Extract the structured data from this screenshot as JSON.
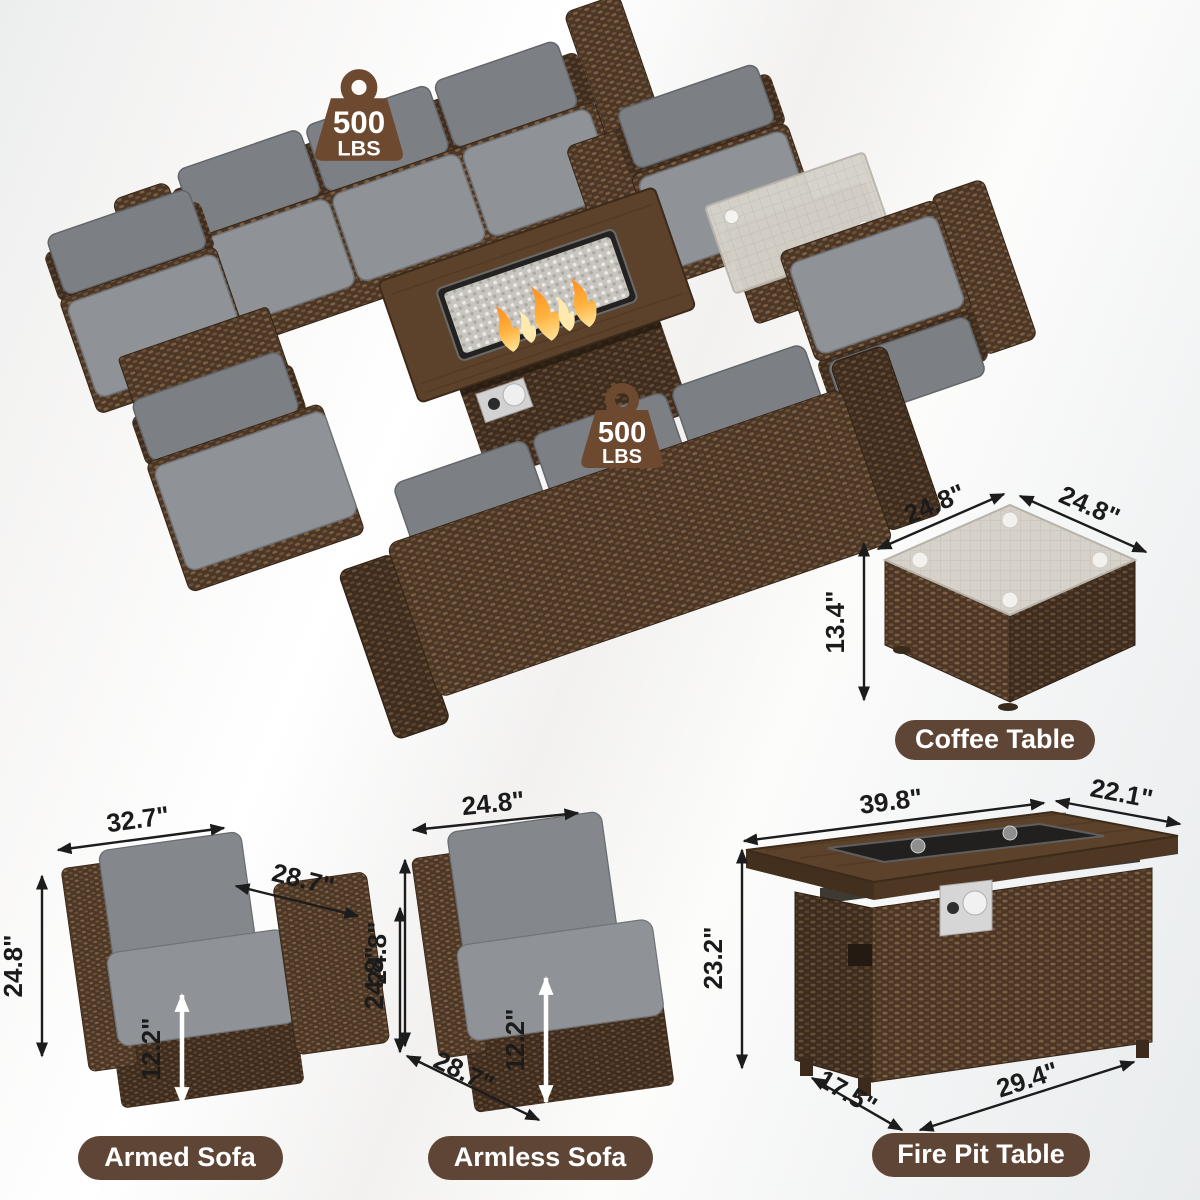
{
  "badges": {
    "weight_1": {
      "value": "500",
      "unit": "LBS"
    },
    "weight_2": {
      "value": "500",
      "unit": "LBS"
    }
  },
  "coffee_table": {
    "label": "Coffee Table",
    "dim_top_left": "24.8\"",
    "dim_top_right": "24.8\"",
    "dim_height": "13.4\""
  },
  "armed_sofa": {
    "label": "Armed Sofa",
    "dim_width": "32.7\"",
    "dim_arm_depth": "28.7\"",
    "dim_height_left": "24.8\"",
    "dim_height_right": "24.8\"",
    "dim_seat_height": "12.2\""
  },
  "armless_sofa": {
    "label": "Armless Sofa",
    "dim_width": "24.8\"",
    "dim_height": "24.8\"",
    "dim_seat_height": "12.2\"",
    "dim_depth": "28.7\""
  },
  "fire_pit_table": {
    "label": "Fire Pit Table",
    "dim_length": "39.8\"",
    "dim_top_depth": "22.1\"",
    "dim_height": "23.2\"",
    "dim_base_depth": "17.5\"",
    "dim_base_length": "29.4\""
  },
  "colors": {
    "pill_bg": "#5e4536",
    "badge_brown": "#6d4930",
    "dim_text": "#1b1b1b",
    "wicker_dark": "#4c3726",
    "wicker_deep": "#3e2c1e",
    "cushion_gray": "#84888c",
    "glass": "#d6d2ca",
    "flame_orange": "#ff8b1f"
  }
}
